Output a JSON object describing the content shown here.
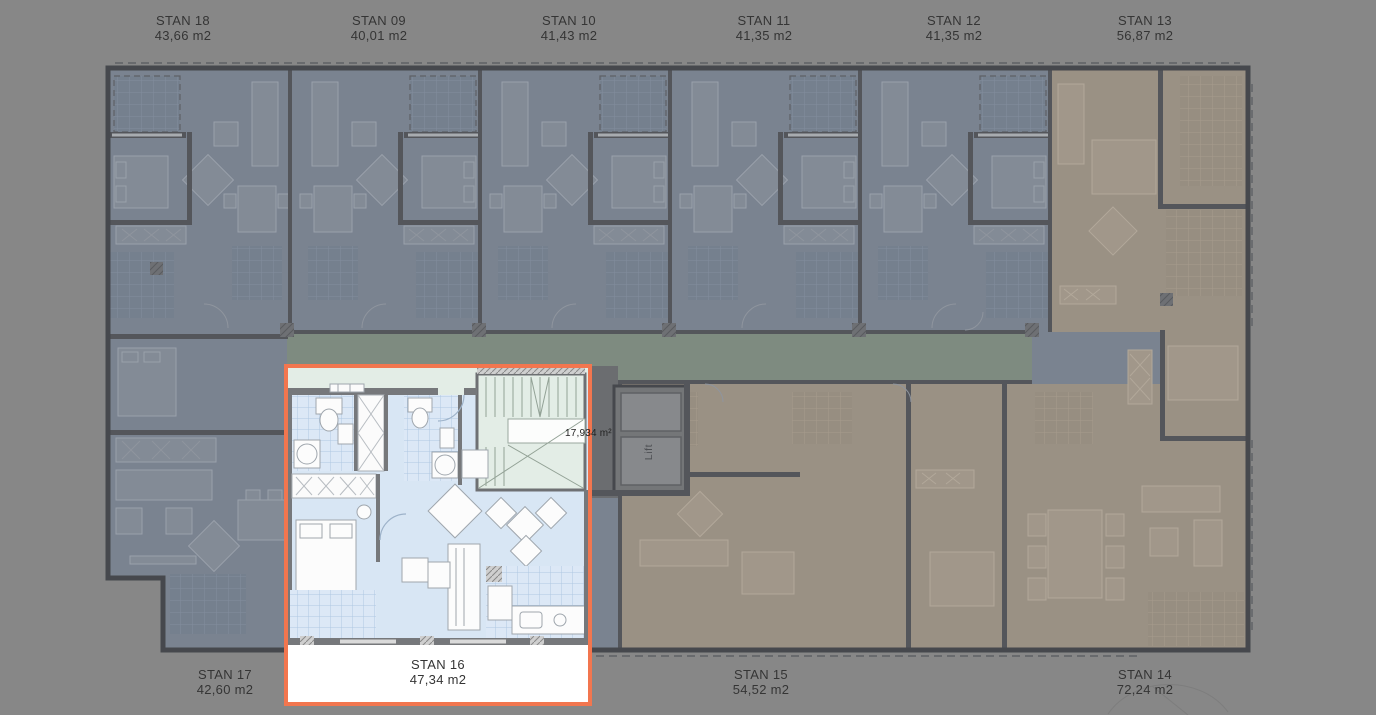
{
  "palette": {
    "background": "#878787",
    "selection_border": "#F2764F",
    "label_text": "#353535",
    "floor_blue_dim": "#7A8390",
    "floor_tan_dim": "#9A9184",
    "corridor_green_dim": "#7E8B80",
    "floor_blue_bright": "#D8E6F4",
    "stairwell_green_bright": "#E3EDE6",
    "wall_dim": "#54565B"
  },
  "top_apartments": [
    {
      "name": "STAN 18",
      "area": "43,66 m2"
    },
    {
      "name": "STAN 09",
      "area": "40,01 m2"
    },
    {
      "name": "STAN 10",
      "area": "41,43 m2"
    },
    {
      "name": "STAN 11",
      "area": "41,35 m2"
    },
    {
      "name": "STAN 12",
      "area": "41,35 m2"
    },
    {
      "name": "STAN 13",
      "area": "56,87 m2"
    }
  ],
  "bottom_apartments": [
    {
      "name": "STAN 17",
      "area": "42,60 m2"
    },
    {
      "name": "STAN 16",
      "area": "47,34 m2",
      "selected": true
    },
    {
      "name": "STAN 15",
      "area": "54,52 m2"
    },
    {
      "name": "STAN 14",
      "area": "72,24 m2"
    }
  ],
  "plan_annotations": {
    "stairwell_area": "17,934 m²",
    "lift": "Lift"
  }
}
